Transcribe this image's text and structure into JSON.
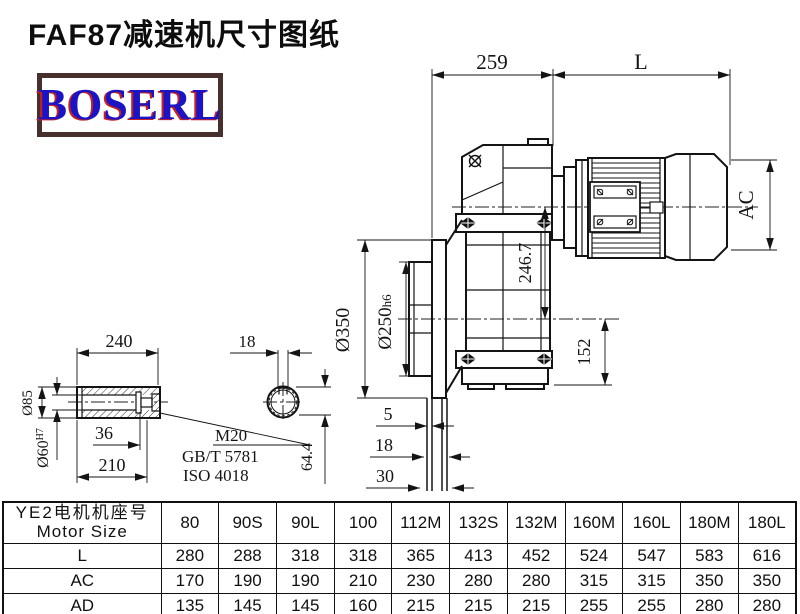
{
  "title": "FAF87减速机尺寸图纸",
  "logo": {
    "text": "BOSERL"
  },
  "colors": {
    "logo_text": "#1c14c4",
    "logo_shadow": "#c8201c",
    "logo_border": "#47302b",
    "line": "#141414"
  },
  "drawing": {
    "dims": {
      "d259": "259",
      "L": "L",
      "AC": "AC",
      "d246_7": "246.7",
      "d350": "Ø350",
      "d250_main": "Ø250",
      "d250_tol": "h6",
      "d152": "152",
      "d5": "5",
      "d18_tube": "18",
      "d30": "30",
      "d64_4": "64.4",
      "d18_key": "18",
      "d240": "240",
      "d210": "210",
      "d36": "36",
      "d85": "Ø85",
      "d60_main": "Ø60",
      "d60_tol": "H7",
      "m20": "M20",
      "gbt": "GB/T 5781",
      "iso": "ISO 4018"
    }
  },
  "table": {
    "header_cn": "YE2电机机座号",
    "header_en": "Motor Size",
    "columns": [
      "80",
      "90S",
      "90L",
      "100",
      "112M",
      "132S",
      "132M",
      "160M",
      "160L",
      "180M",
      "180L"
    ],
    "rows": [
      {
        "label": "L",
        "values": [
          "280",
          "288",
          "318",
          "318",
          "365",
          "413",
          "452",
          "524",
          "547",
          "583",
          "616"
        ]
      },
      {
        "label": "AC",
        "values": [
          "170",
          "190",
          "190",
          "210",
          "230",
          "280",
          "280",
          "315",
          "315",
          "350",
          "350"
        ]
      },
      {
        "label": "AD",
        "values": [
          "135",
          "145",
          "145",
          "160",
          "215",
          "215",
          "215",
          "255",
          "255",
          "280",
          "280"
        ]
      }
    ]
  }
}
